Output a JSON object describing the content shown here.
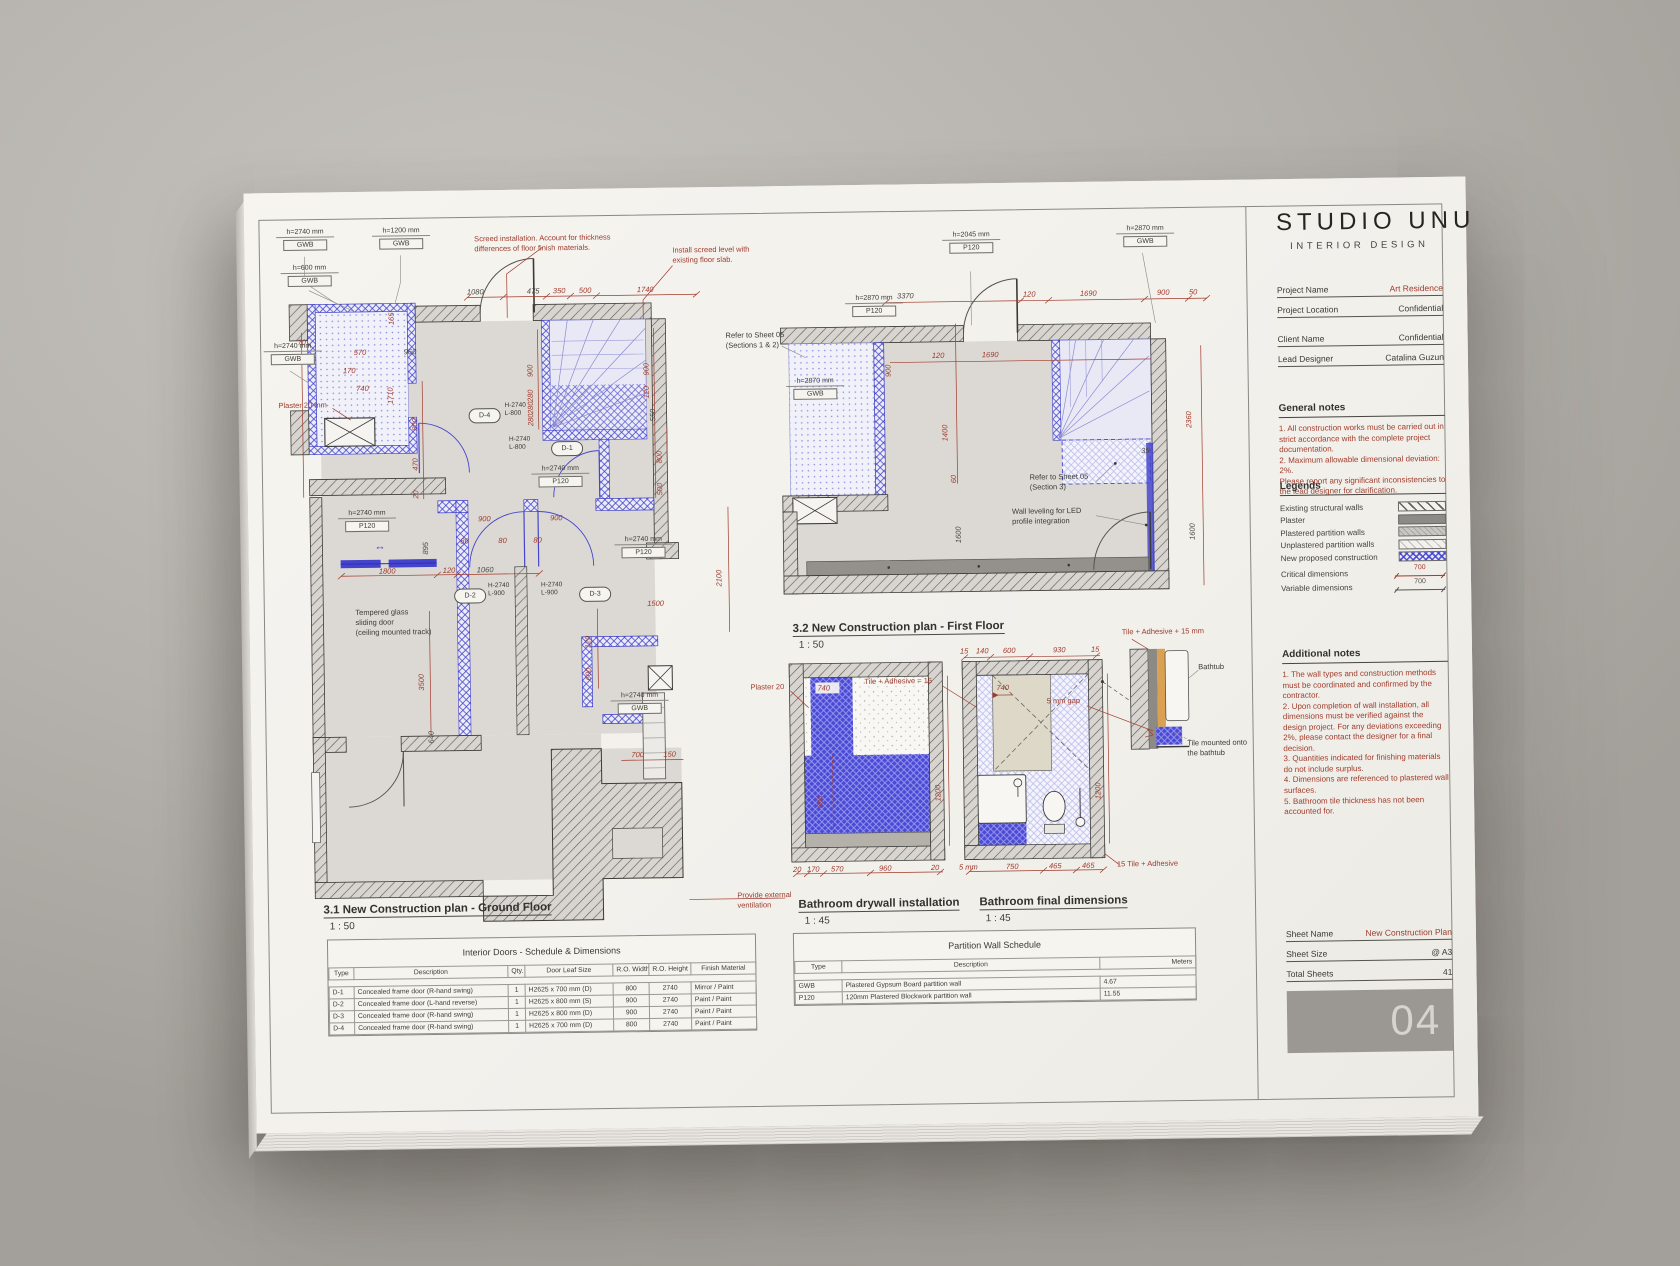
{
  "colors": {
    "accent_red": "#9e3b2d",
    "blue_new": "#3d3dd2",
    "paper": "#f3f1ec",
    "background": "#b5b2ad"
  },
  "brand": {
    "name": "STUDIO UNU",
    "tagline": "INTERIOR DESIGN"
  },
  "title_block": {
    "fields": [
      {
        "label": "Project Name",
        "value": "Art Residence"
      },
      {
        "label": "Project Location",
        "value": "Confidential"
      },
      {
        "label": "Client Name",
        "value": "Confidential"
      },
      {
        "label": "Lead Designer",
        "value": "Catalina Guzun"
      }
    ],
    "general_notes": {
      "title": "General notes",
      "body": "1. All construction works must be carried out in strict accordance with the complete project documentation.\n2. Maximum allowable dimensional deviation: 2%.\nPlease report any significant inconsistencies to the lead designer for clarification."
    },
    "legends": {
      "title": "Legends",
      "items": [
        "Existing structural walls",
        "Plaster",
        "Plastered partition walls",
        "Unplastered partition walls",
        "New proposed construction"
      ],
      "critical": {
        "label": "Critical dimensions",
        "value": "700"
      },
      "variable": {
        "label": "Variable dimensions",
        "value": "700"
      }
    },
    "additional_notes": {
      "title": "Additional notes",
      "body": "1. The wall types and construction methods must be coordinated and confirmed by the contractor.\n2. Upon completion of wall installation, all dimensions must be verified against the design project. For any deviations exceeding 2%, please contact the designer for a final decision.\n3. Quantities indicated for finishing materials do not include surplus.\n4. Dimensions are referenced to plastered wall surfaces.\n5. Bathroom tile thickness has not been accounted for."
    },
    "sheet_info": [
      {
        "label": "Sheet Name",
        "value": "New Construction Plan"
      },
      {
        "label": "Sheet Size",
        "value": "@ A3"
      },
      {
        "label": "Total Sheets",
        "value": "41"
      }
    ],
    "sheet_number": "04"
  },
  "plans": {
    "ground": {
      "title": "3.1 New Construction plan - Ground Floor",
      "scale": "1 : 50",
      "dims": [
        "1080",
        "475",
        "350",
        "500",
        "1740",
        "165",
        "70",
        "570",
        "960",
        "170",
        "740",
        "1710",
        "800",
        "470",
        "20",
        "900",
        "280",
        "280",
        "280",
        "900",
        "120",
        "550",
        "800",
        "500",
        "900",
        "900",
        "80",
        "80",
        "80",
        "895",
        "1800",
        "120",
        "1060",
        "1500",
        "120",
        "600",
        "2100",
        "3500",
        "700",
        "150",
        "640"
      ]
    },
    "first": {
      "title": "3.2 New Construction plan - First Floor",
      "scale": "1 : 50",
      "dims": [
        "3370",
        "120",
        "1690",
        "900",
        "50",
        "900",
        "1400",
        "60",
        "1600",
        "120",
        "1690",
        "2360",
        "1600",
        "35"
      ]
    },
    "bath_drywall": {
      "title": "Bathroom drywall installation",
      "scale": "1 : 45",
      "dims": [
        "20",
        "170",
        "570",
        "960",
        "20",
        "600",
        "1200",
        "740"
      ]
    },
    "bath_final": {
      "title": "Bathroom final dimensions",
      "scale": "1 : 45",
      "dims": [
        "15",
        "140",
        "600",
        "930",
        "15",
        "5 mm",
        "750",
        "465",
        "465",
        "1200",
        "740"
      ]
    }
  },
  "tags": [
    {
      "h": "h=2740 mm",
      "t": "GWB"
    },
    {
      "h": "h=1200 mm",
      "t": "GWB"
    },
    {
      "h": "h=600 mm",
      "t": "GWB"
    },
    {
      "h": "h=2740 mm",
      "t": "GWB"
    },
    {
      "h": "h=2740 mm",
      "t": "P120"
    },
    {
      "h": "h=2740 mm",
      "t": "P120"
    },
    {
      "h": "h=2740 mm",
      "t": "P120"
    },
    {
      "h": "h=2740 mm",
      "t": "GWB"
    },
    {
      "h": "h=2045 mm",
      "t": "P120"
    },
    {
      "h": "h=2870 mm",
      "t": "GWB"
    },
    {
      "h": "h=2870 mm",
      "t": "P120"
    },
    {
      "h": "h=2870 mm",
      "t": "GWB"
    }
  ],
  "door_marks": [
    {
      "no": "D-4",
      "size": "H-2740\nL-800"
    },
    {
      "no": "D-1",
      "size": "H-2740\nL-800"
    },
    {
      "no": "D-2",
      "size": "H-2740\nL-900"
    },
    {
      "no": "D-3",
      "size": "H-2740\nL-900"
    }
  ],
  "annotations": {
    "screed": "Screed installation. Account for thickness\ndifferences of floor finish materials.",
    "screed_level": "Install screed level with\nexisting floor slab.",
    "refer12": "Refer to Sheet 05\n(Sections 1 & 2)",
    "refer3": "Refer to Sheet 05\n(Section 3)",
    "led": "Wall leveling for LED\nprofile integration",
    "tempered": "Tempered glass\nsliding door\n(ceiling mounted track)",
    "vent": "Provide external\nventilation",
    "plaster20mm": "Plaster 20 mm",
    "plaster20": "Plaster 20",
    "tile_eq": "Tile + Adhesive = 15",
    "tile_plus": "Tile + Adhesive + 15 mm",
    "tile15": "15 Tile + Adhesive",
    "gap": "5 mm gap",
    "bathtub": "Bathtub",
    "tile_mounted": "Tile mounted onto\nthe bathtub",
    "sliding_icon": "↔"
  },
  "tables": {
    "doors": {
      "title": "Interior Doors - Schedule & Dimensions",
      "headers": [
        "Type",
        "Description",
        "Qty.",
        "Door Leaf Size",
        "R.O. Width",
        "R.O. Height",
        "Finish Material"
      ],
      "rows": [
        [
          "D-1",
          "Concealed frame door (R-hand swing)",
          "1",
          "H2625 x 700 mm (D)",
          "800",
          "2740",
          "Mirror / Paint"
        ],
        [
          "D-2",
          "Concealed frame door (L-hand reverse)",
          "1",
          "H2625 x 800 mm (S)",
          "900",
          "2740",
          "Paint / Paint"
        ],
        [
          "D-3",
          "Concealed frame door (R-hand swing)",
          "1",
          "H2625 x 800 mm (D)",
          "900",
          "2740",
          "Paint / Paint"
        ],
        [
          "D-4",
          "Concealed frame door (R-hand swing)",
          "1",
          "H2625 x 700 mm (D)",
          "800",
          "2740",
          "Paint / Paint"
        ]
      ]
    },
    "partitions": {
      "title": "Partition Wall Schedule",
      "headers": [
        "Type",
        "Description",
        "Meters"
      ],
      "rows": [
        [
          "GWB",
          "Plastered Gypsum Board partition wall",
          "4.67"
        ],
        [
          "P120",
          "120mm Plastered Blockwork partition wall",
          "11.55"
        ]
      ]
    }
  }
}
